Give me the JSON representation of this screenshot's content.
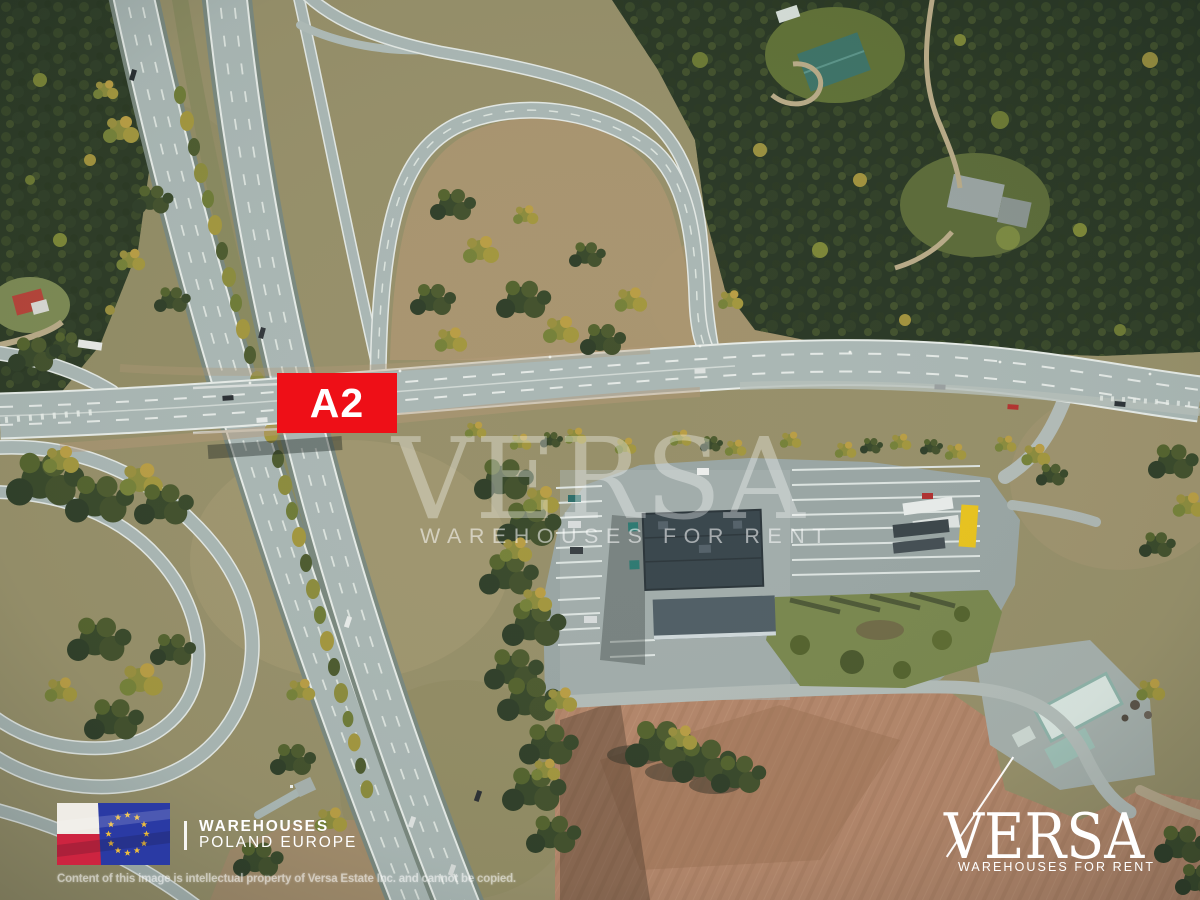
{
  "image": {
    "kind": "aerial drone photograph",
    "description": "Aerial view of the A2 motorway interchange with cloverleaf ramps, a truck-stop building with parking, forest and plowed fields",
    "width": 1200,
    "height": 900
  },
  "badge": {
    "label": "A2",
    "background_color": "#ee0f17",
    "text_color": "#ffffff"
  },
  "center_watermark": {
    "brand": "VERSA",
    "tagline": "WAREHOUSES FOR RENT"
  },
  "footer_left": {
    "line1": "WAREHOUSES",
    "line2": "POLAND EUROPE",
    "flags": [
      "poland-flag",
      "eu-flag"
    ],
    "flag_colors": {
      "poland_white": "#efece6",
      "poland_red": "#cd2440",
      "eu_blue": "#2a3aa4",
      "eu_star_gold": "#eebd3e"
    }
  },
  "footer_logo": {
    "brand": "VERSA",
    "tagline": "WAREHOUSES FOR RENT"
  },
  "copyright_notice": "Content of this image is intellectual property of Versa Estate Inc. and cannot be copied.",
  "scene": {
    "features": [
      "motorway",
      "overpass-road",
      "north-loop-ramp",
      "southwest-loop-ramps",
      "truck-stop-building",
      "parking-lot",
      "landscaped-island",
      "farmstead",
      "plowed-field",
      "forest-northeast",
      "forest-west",
      "houses-in-forest"
    ],
    "colors": {
      "grass": "#97906a",
      "forest": "#2c3a26",
      "asphalt": "#aab7b4",
      "parking": "#9aa6a4",
      "building_roof": "#3a474d",
      "field": "#b4876b"
    }
  }
}
